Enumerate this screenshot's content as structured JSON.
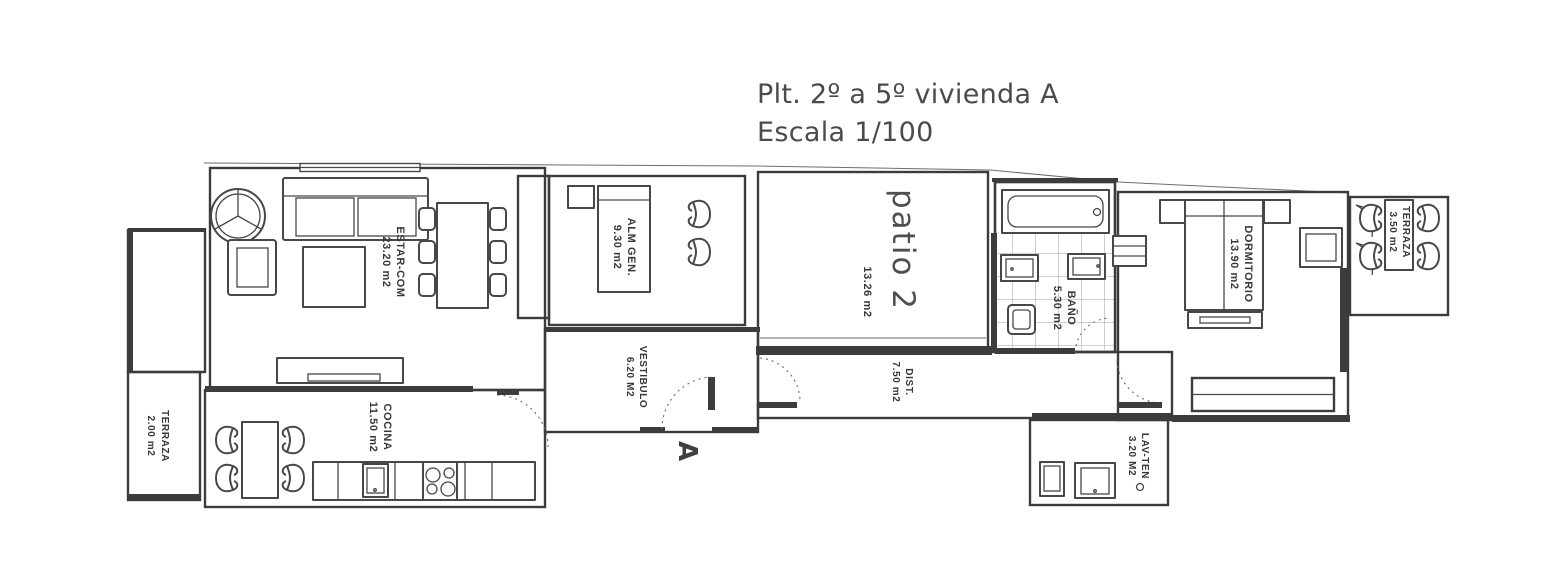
{
  "title": {
    "line1": "Plt. 2º a 5º vivienda A",
    "line2": "Escala 1/100"
  },
  "rooms": {
    "estar": {
      "name": "ESTAR-COM",
      "area": "23.20 m2"
    },
    "alm_gen": {
      "name": "ALM GEN.",
      "area": "9.30 m2"
    },
    "patio": {
      "name": "patio 2",
      "area": "13.26 m2"
    },
    "bano": {
      "name": "BAÑO",
      "area": "5.30 m2"
    },
    "dormitorio": {
      "name": "DORMITORIO",
      "area": "13.90 m2"
    },
    "terraza_right": {
      "name": "TERRAZA",
      "area": "3.50 m2"
    },
    "terraza_left": {
      "name": "TERRAZA",
      "area": "2.00 m2"
    },
    "cocina": {
      "name": "COCINA",
      "area": "11.50 m2"
    },
    "vestibulo": {
      "name": "VESTIBULO",
      "area": "6.20 M2"
    },
    "dist": {
      "name": "DIST.",
      "area": "7.50 m2"
    },
    "lav_ten": {
      "name": "LAV-TEN",
      "area": "3.20 M2"
    }
  },
  "markers": {
    "section_label": "A"
  },
  "colors": {
    "wall": "#3c3c3c",
    "floor_stripe": "#b6b6b6",
    "tile_line": "#a2a2a2",
    "label_text": "#383838",
    "title_text": "#4b4b4b"
  }
}
